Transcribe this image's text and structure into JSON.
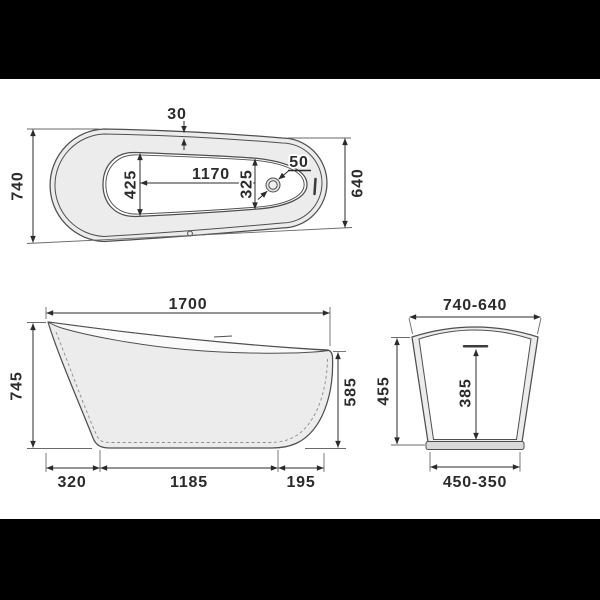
{
  "meta": {
    "type": "technical-dimension-drawing",
    "subject": "freestanding slipper bathtub, three orthographic views"
  },
  "colors": {
    "background": "#000000",
    "paper": "#ffffff",
    "line": "#4f4f4f",
    "dark": "#2b2b2b",
    "fill_light": "#ececec",
    "fill_mid": "#d9d9d9"
  },
  "top_view": {
    "rim_width_top": "30",
    "overall_width": "740",
    "inner_width_head": "425",
    "inner_length": "1170",
    "inner_width_foot": "325",
    "drain_diameter": "50",
    "overall_width_foot": "640"
  },
  "side_view": {
    "overall_length": "1700",
    "height_back": "745",
    "height_front": "585",
    "base_setback_back": "320",
    "base_length": "1185",
    "base_setback_front": "195"
  },
  "end_view": {
    "width_top": "740-640",
    "height": "455",
    "depth_inner": "385",
    "width_base": "450-350"
  }
}
